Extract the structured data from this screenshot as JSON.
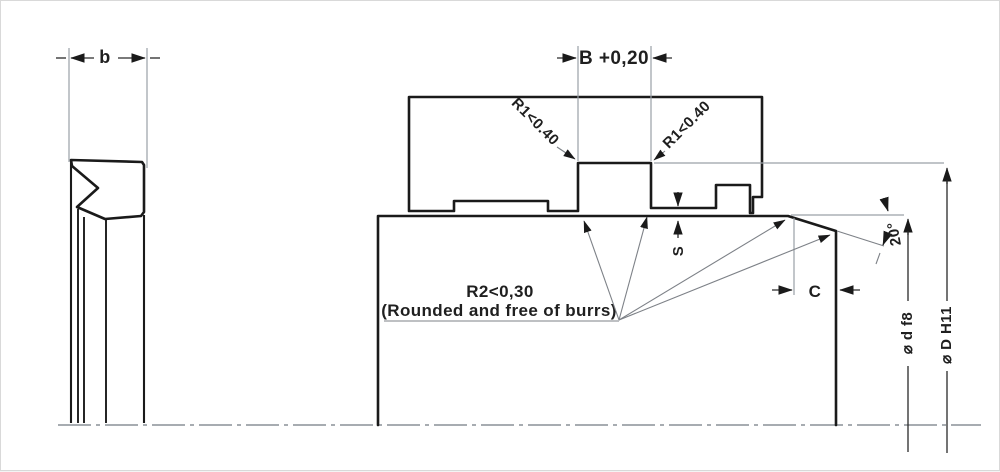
{
  "drawing": {
    "labels": {
      "seal_width": "b",
      "groove_width": "B +0,20",
      "radius1_left": "R1<0.40",
      "radius1_right": "R1<0.40",
      "radius2_note_line1": "R2<0,30",
      "radius2_note_line2": "(Rounded and free of burrs)",
      "lip_gap": "S",
      "chamfer_length": "C",
      "chamfer_angle": "20°",
      "rod_diameter": "⌀ d f8",
      "bore_diameter": "⌀ D H11"
    },
    "colors": {
      "outline": "#1a1a1a",
      "seal_fill": "#d2d4d6",
      "hatch": "#a8adb3",
      "dim_line": "#9aa0a6",
      "background": "#ffffff"
    }
  }
}
